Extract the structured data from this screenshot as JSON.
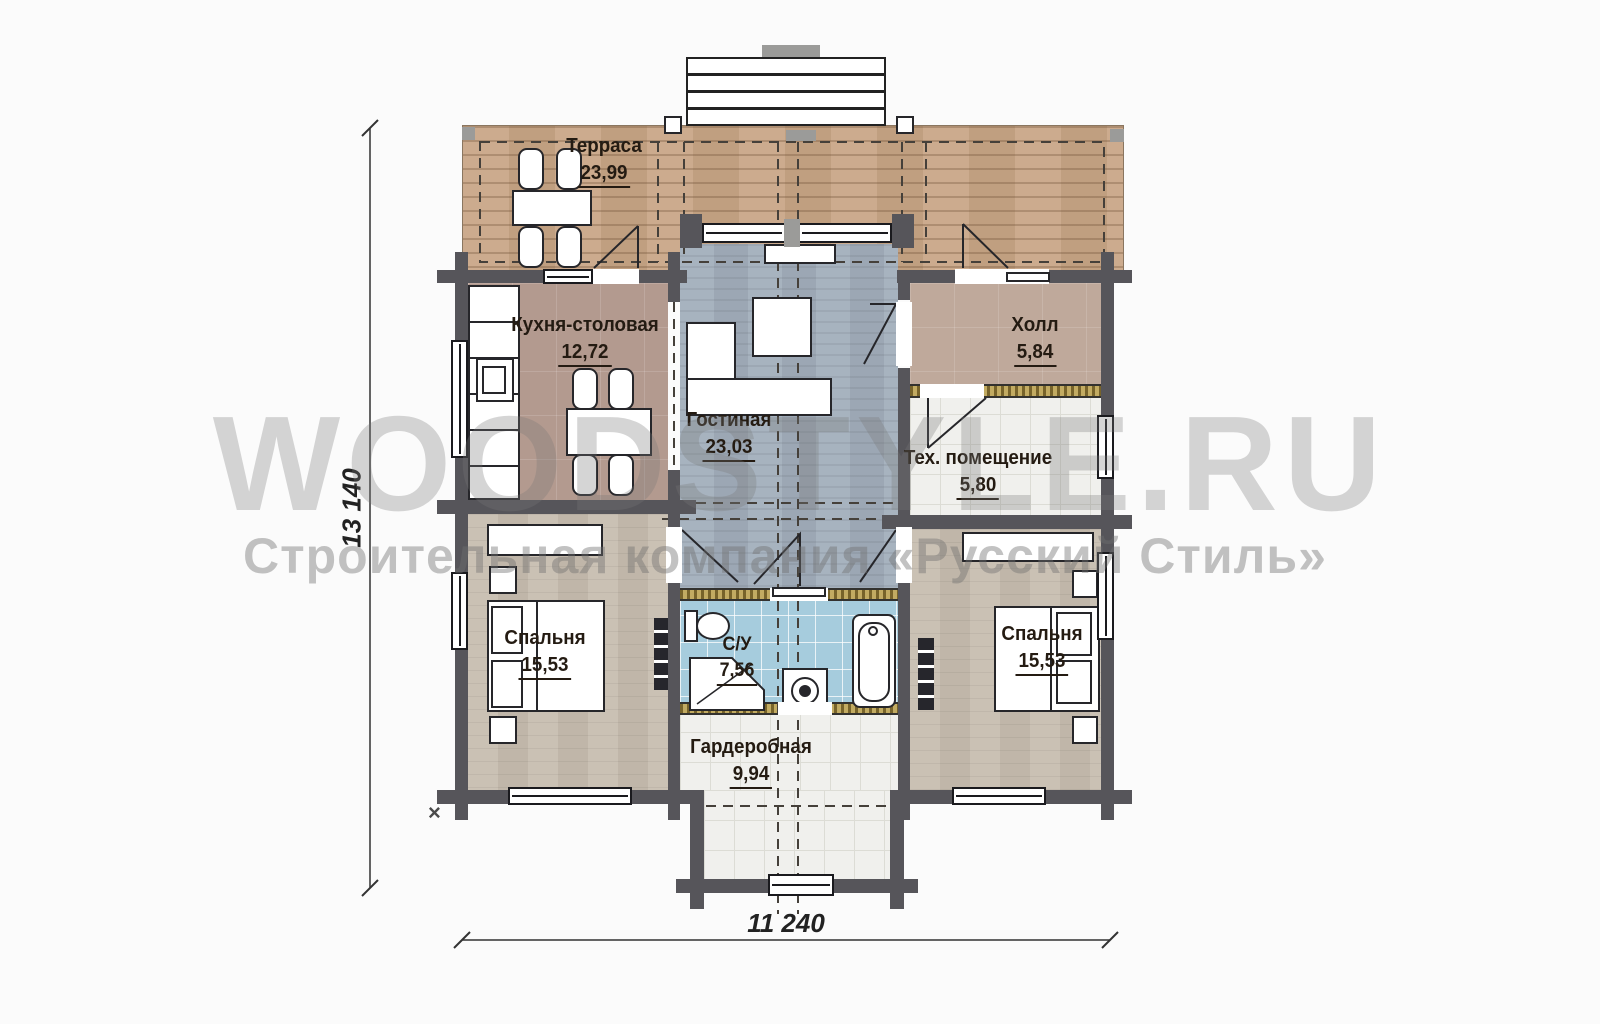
{
  "watermark": {
    "line1": "WOODSTYLE.RU",
    "line2": "Строительная компания «Русский Стиль»"
  },
  "rooms": {
    "terrace": {
      "name": "Терраса",
      "area": "23,99"
    },
    "kitchen": {
      "name": "Кухня-столовая",
      "area": "12,72"
    },
    "living": {
      "name": "Гостиная",
      "area": "23,03"
    },
    "hall": {
      "name": "Холл",
      "area": "5,84"
    },
    "tech": {
      "name": "Тех. помещение",
      "area": "5,80"
    },
    "bedroom_left": {
      "name": "Спальня",
      "area": "15,53"
    },
    "bedroom_right": {
      "name": "Спальня",
      "area": "15,53"
    },
    "bathroom": {
      "name": "С/У",
      "area": "7,56"
    },
    "wardrobe": {
      "name": "Гардеробная",
      "area": "9,94"
    }
  },
  "dimensions": {
    "overall_height": "13 140",
    "overall_width": "11 240"
  },
  "annotations": {
    "corner_mark": "×"
  },
  "colors": {
    "wall": "#56555a",
    "terrace_wood": "#c8a585",
    "living_floor": "#a2aebb",
    "bedroom_floor": "#c6bcae",
    "kitchen_floor": "#b39a8f",
    "hall_floor": "#bfa99b",
    "bath_tile": "#a6ccdd",
    "light_tile": "#f0f0ed",
    "partition_hatch": "#b49b55",
    "watermark_grey": "#8c8c8c"
  }
}
